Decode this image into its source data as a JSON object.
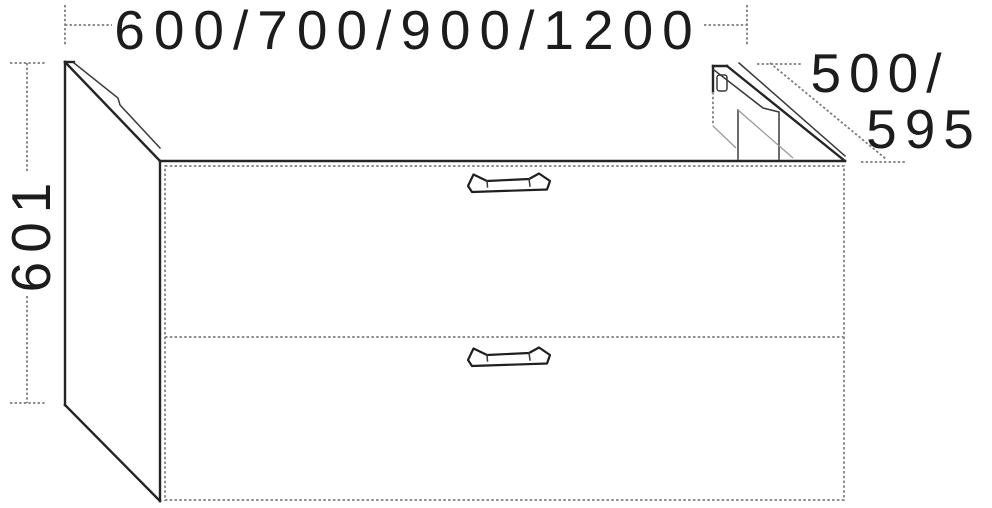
{
  "drawing": {
    "type": "furniture-dimension-diagram",
    "subject": "two-drawer vanity base unit, isometric line drawing",
    "colors": {
      "outline": "#252525",
      "secondary_lines": "#8f8f8f",
      "dimension_lines": "#7d7d7d",
      "background": "#ffffff"
    },
    "dimensions": {
      "width": {
        "label": "600/700/900/1200",
        "values_mm": [
          600,
          700,
          900,
          1200
        ]
      },
      "height": {
        "label": "601",
        "values_mm": [
          601
        ]
      },
      "depth": {
        "label_line1": "500/",
        "label_line2": "595",
        "values_mm": [
          500,
          595
        ]
      }
    },
    "features": {
      "drawer_count": 2,
      "handle_type": "bar-handle",
      "rear_cutout": "plumbing recess at back right"
    }
  }
}
